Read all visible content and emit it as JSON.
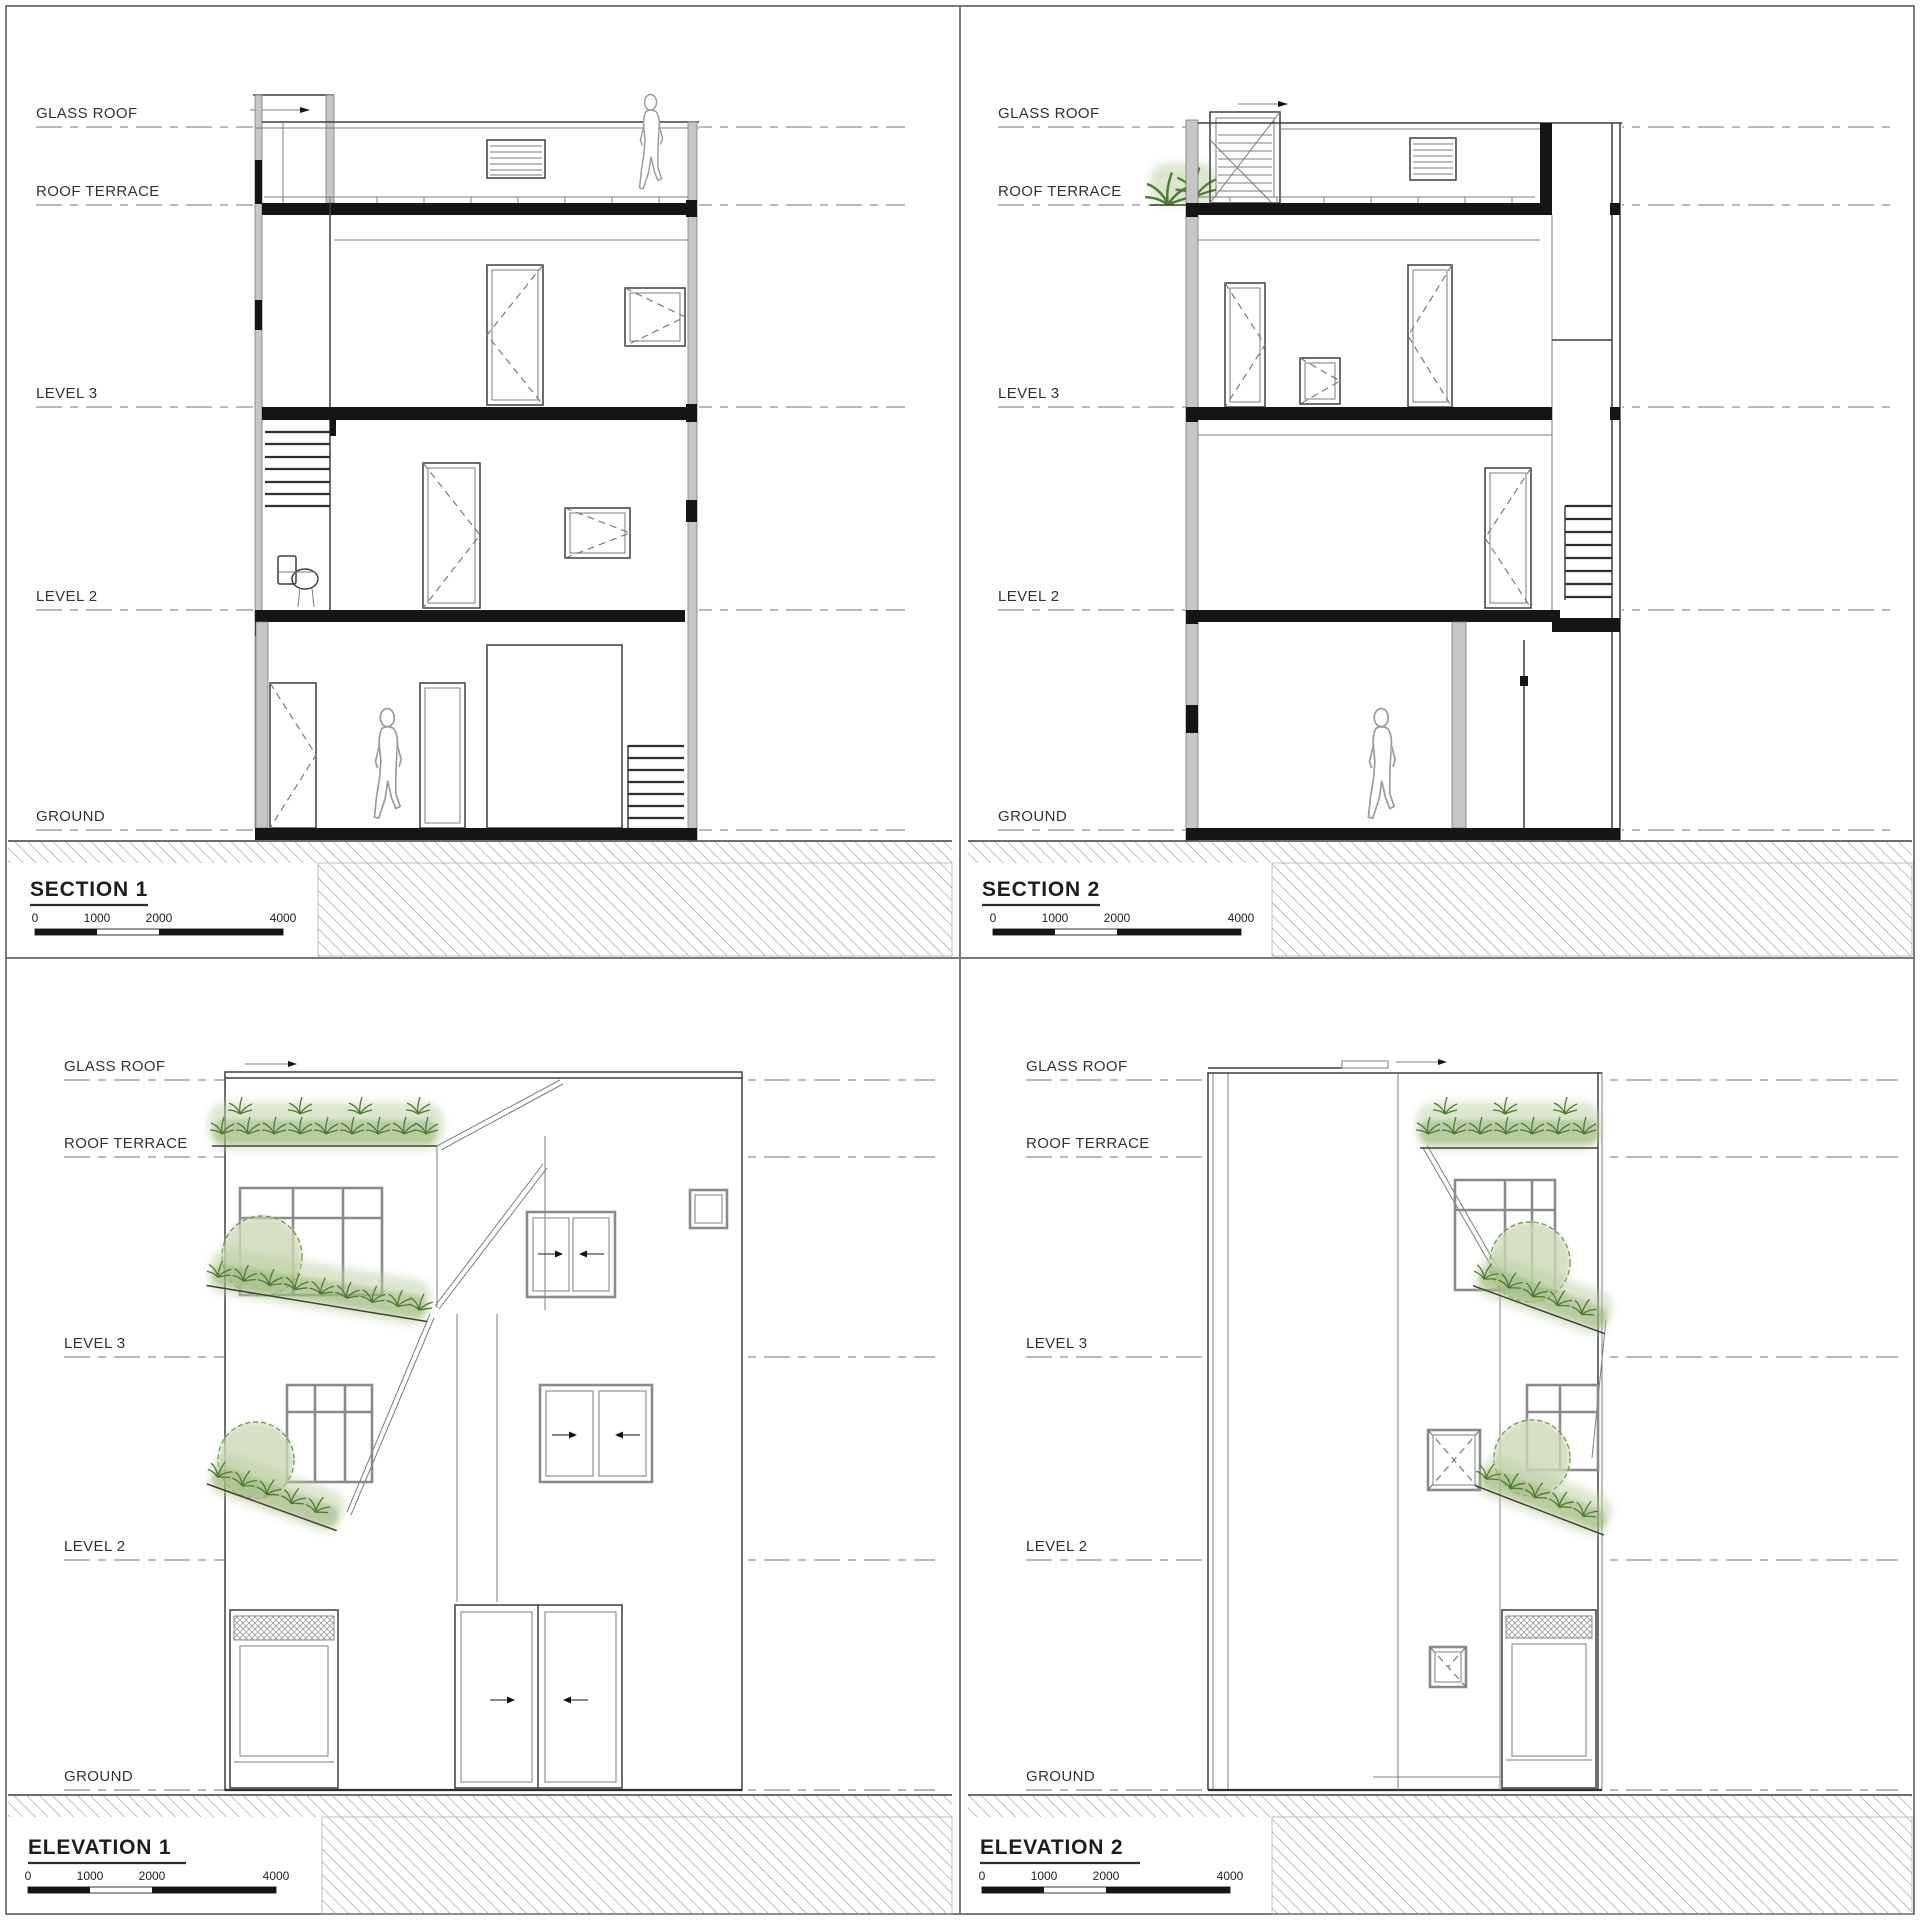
{
  "sheet": {
    "type": "architectural-drawing-sheet",
    "levels": [
      "GLASS ROOF",
      "ROOF TERRACE",
      "LEVEL 3",
      "LEVEL 2",
      "GROUND"
    ],
    "panels": [
      {
        "id": "section-1",
        "title": "SECTION 1"
      },
      {
        "id": "section-2",
        "title": "SECTION 2"
      },
      {
        "id": "elevation-1",
        "title": "ELEVATION 1"
      },
      {
        "id": "elevation-2",
        "title": "ELEVATION 2"
      }
    ],
    "scale_bar": {
      "labels": [
        "0",
        "1000",
        "2000",
        "4000"
      ]
    },
    "colors": {
      "line": "#3f3f3f",
      "datum": "#a3a3a3",
      "slab": "#151515",
      "hatch": "#8f8f8f",
      "plant_dark": "#4e7a34",
      "plant_soft": "#b9cf9f"
    }
  }
}
